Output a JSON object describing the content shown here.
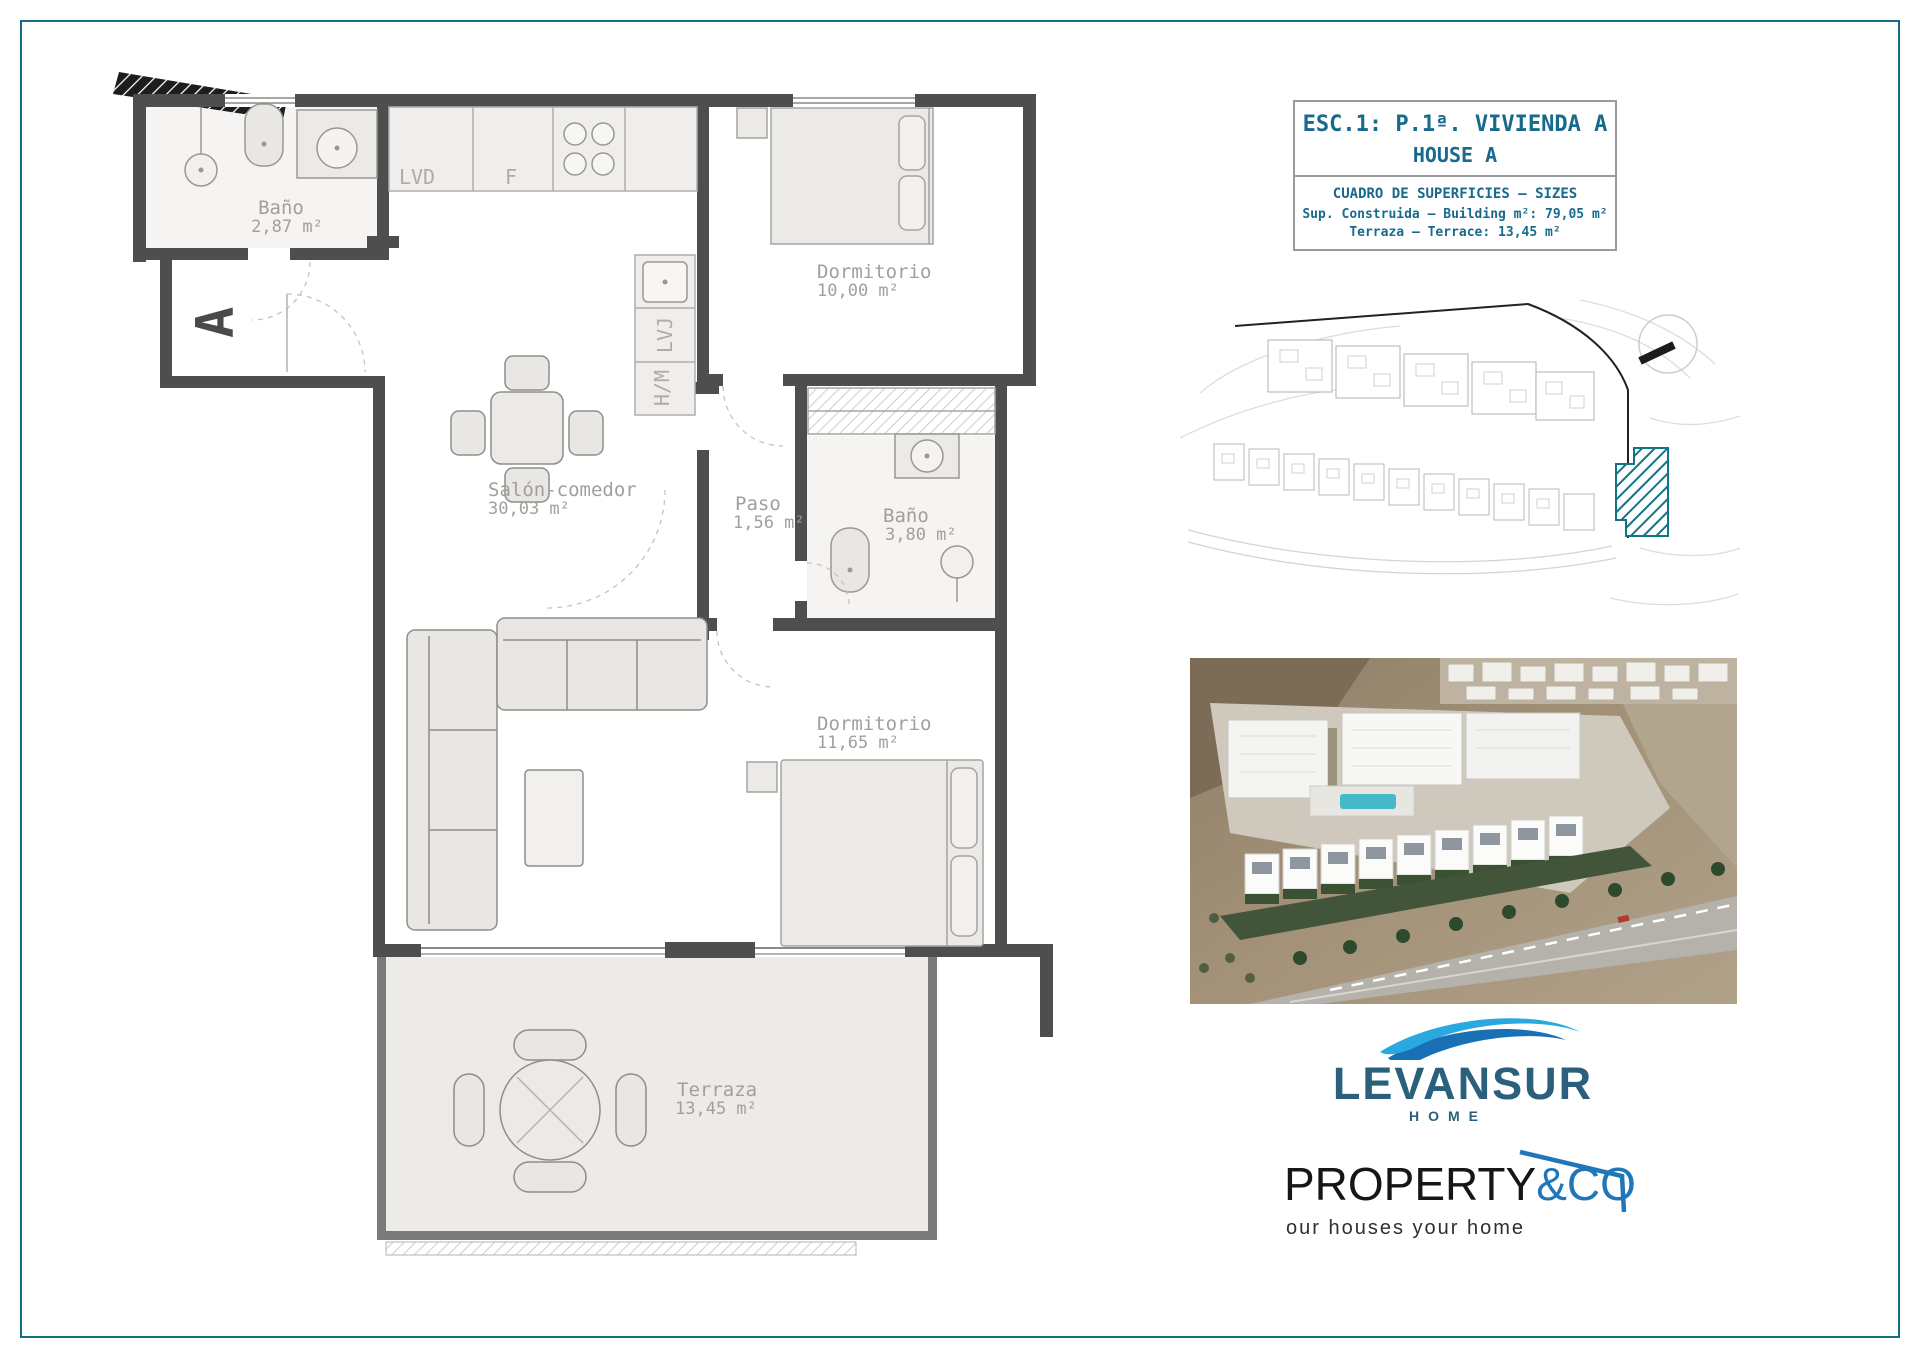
{
  "page": {
    "border_color": "#13707f"
  },
  "title_block": {
    "line1": "ESC.1: P.1ª. VIVIENDA A",
    "line2": "HOUSE A",
    "table_title": "CUADRO DE SUPERFICIES – SIZES",
    "rows": [
      {
        "label": "Sup. Construida – Building m²:",
        "value": "79,05 m²"
      },
      {
        "label": "Terraza – Terrace:",
        "value": "13,45 m²"
      }
    ],
    "text_color": "#176a8c"
  },
  "floor_plan": {
    "stair_label": "A",
    "rooms": [
      {
        "name": "Baño",
        "area": "2,87 m²"
      },
      {
        "name": "Dormitorio",
        "area": "10,00 m²"
      },
      {
        "name": "Salón-comedor",
        "area": "30,03 m²"
      },
      {
        "name": "Paso",
        "area": "1,56 m²"
      },
      {
        "name": "Baño",
        "area": "3,80 m²"
      },
      {
        "name": "Dormitorio",
        "area": "11,65 m²"
      },
      {
        "name": "Terraza",
        "area": "13,45 m²"
      }
    ],
    "appliances": {
      "washer": "LVD",
      "fridge": "F",
      "dishwasher": "LVJ",
      "oven": "H/M"
    }
  },
  "site_plan": {
    "marker_color": "#127585"
  },
  "logos": {
    "levansur": {
      "wordmark": "LEVANSUR",
      "subtitle": "HOME",
      "text_color": "#2a607c",
      "wave_light": "#29a9e0",
      "wave_dark": "#1a70b4"
    },
    "property": {
      "word_black": "PROPERTY",
      "word_blue": "&CO",
      "tagline": "our houses your home",
      "blue": "#1f76b9"
    }
  }
}
